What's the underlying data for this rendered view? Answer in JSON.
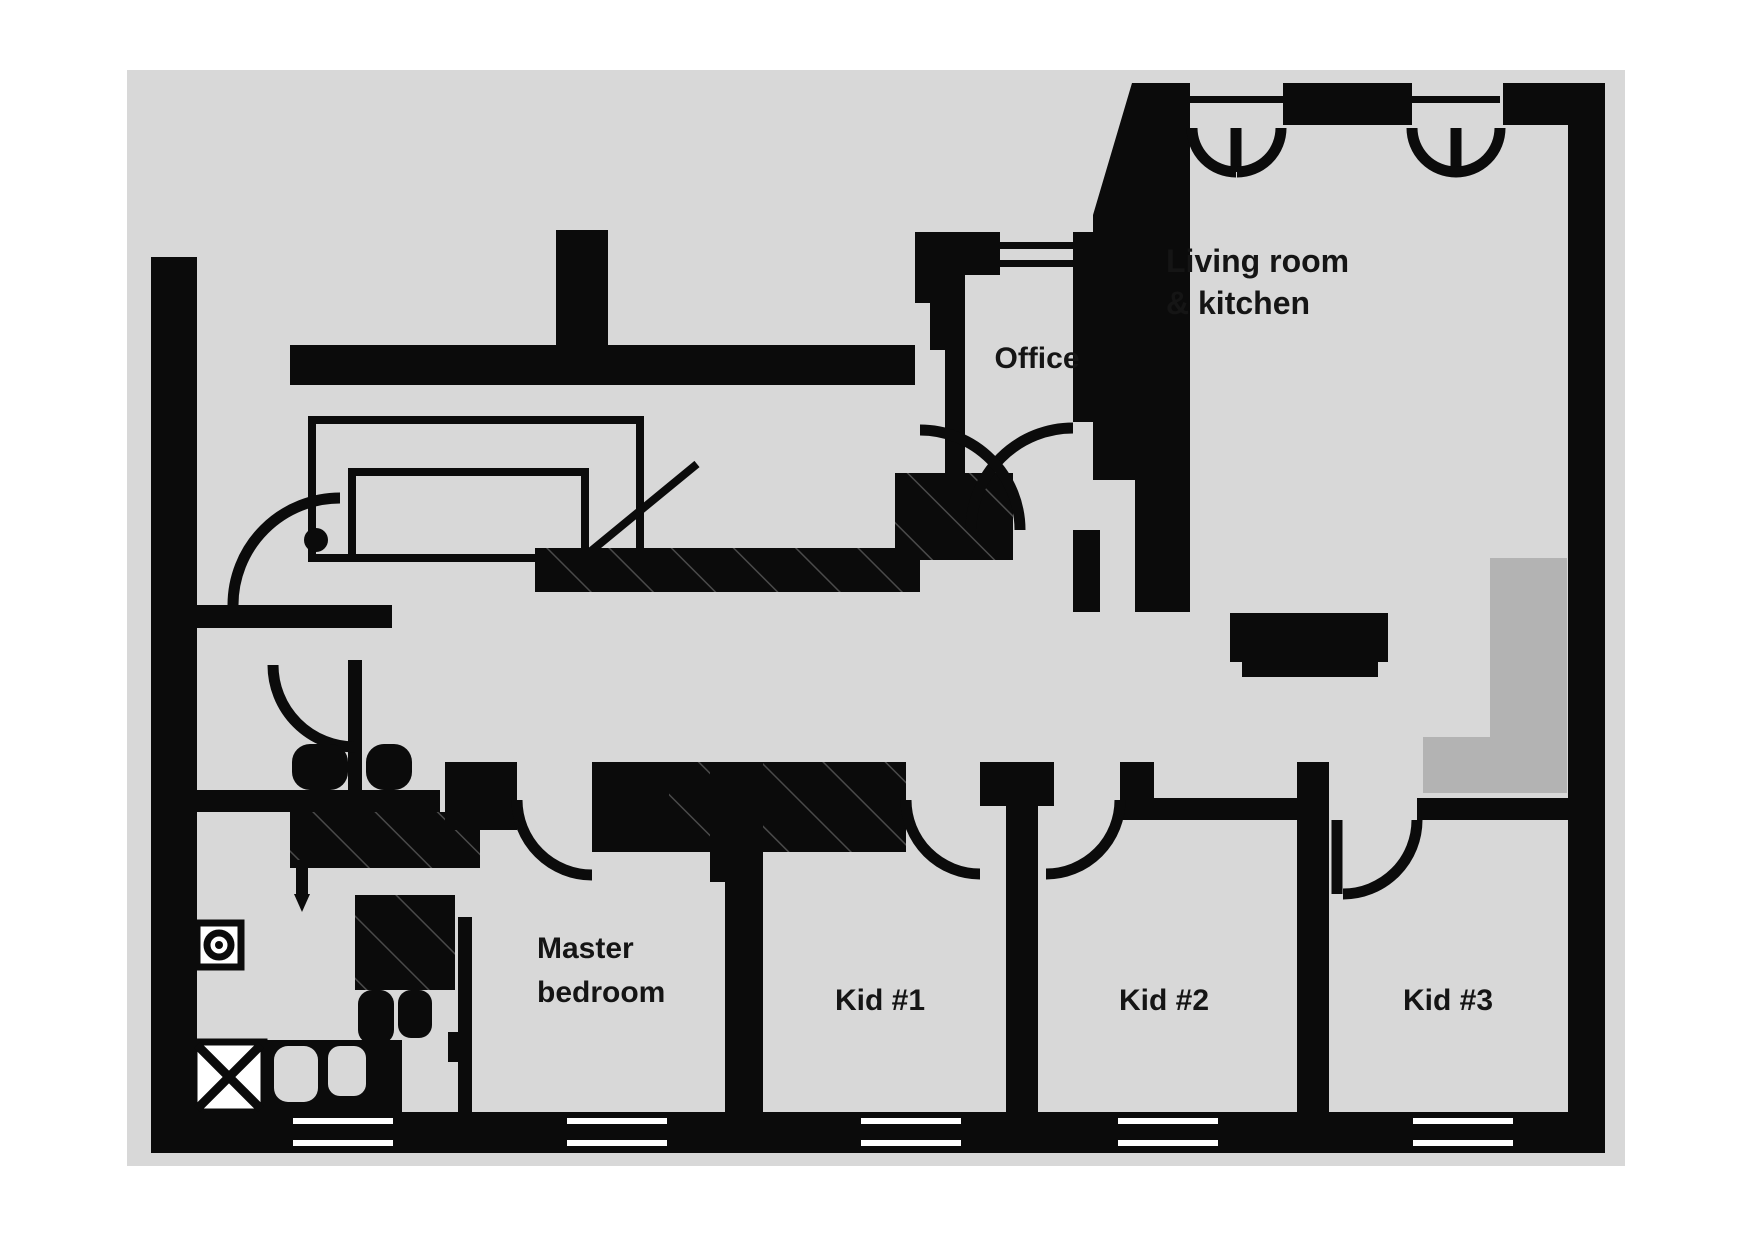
{
  "floor_plan": {
    "colors": {
      "page_background": "#ffffff",
      "floor": "#d8d8d8",
      "wall": "#0b0b0b",
      "alcove": "#b3b3b3",
      "text": "#151515"
    },
    "rooms": {
      "living_kitchen": {
        "label_line1": "Living room",
        "label_line2": "& kitchen"
      },
      "office": {
        "label": "Office"
      },
      "master_bedroom": {
        "label_line1": "Master",
        "label_line2": "bedroom"
      },
      "kid1": {
        "label": "Kid #1"
      },
      "kid2": {
        "label": "Kid #2"
      },
      "kid3": {
        "label": "Kid #3"
      }
    }
  }
}
